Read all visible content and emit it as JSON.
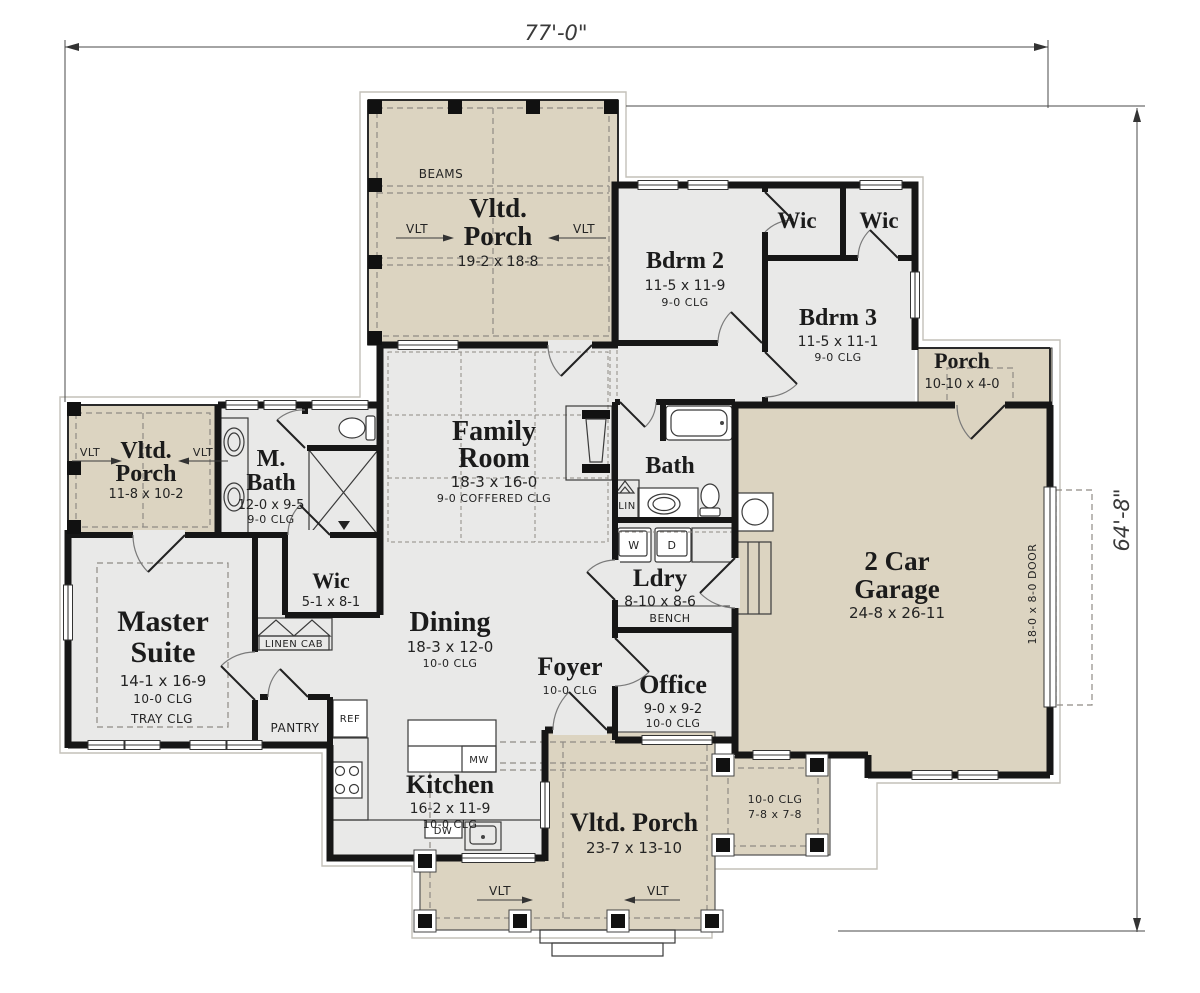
{
  "colors": {
    "paper": "#ffffff",
    "wall": "#161616",
    "porch": "#dcd4c1",
    "room": "#e9e9e8",
    "dash": "#8f8b85",
    "outline": "#c3c0b9"
  },
  "dim": {
    "width": "77'-0\"",
    "height": "64'-8\""
  },
  "rooms": {
    "porch_top": {
      "l1": "Vltd.",
      "l2": "Porch",
      "size": "19-2 x 18-8",
      "beams": "BEAMS",
      "vlt": "VLT"
    },
    "bdrm2": {
      "name": "Bdrm 2",
      "size": "11-5 x 11-9",
      "clg": "9-0 CLG"
    },
    "wic1": {
      "name": "Wic"
    },
    "wic2": {
      "name": "Wic"
    },
    "bdrm3": {
      "name": "Bdrm 3",
      "size": "11-5 x 11-1",
      "clg": "9-0 CLG"
    },
    "porch_right": {
      "name": "Porch",
      "size": "10-10 x 4-0"
    },
    "family": {
      "l1": "Family",
      "l2": "Room",
      "size": "18-3 x 16-0",
      "clg": "9-0 COFFERED CLG"
    },
    "bath": {
      "name": "Bath",
      "lin": "LIN"
    },
    "m_bath": {
      "l1": "M.",
      "l2": "Bath",
      "size": "12-0 x 9-5",
      "clg": "9-0 CLG"
    },
    "porch_left": {
      "l1": "Vltd.",
      "l2": "Porch",
      "size": "11-8 x 10-2",
      "vlt": "VLT"
    },
    "master": {
      "l1": "Master",
      "l2": "Suite",
      "size": "14-1 x 16-9",
      "clg": "10-0 CLG",
      "tray": "TRAY CLG"
    },
    "wic3": {
      "name": "Wic",
      "size": "5-1 x 8-1"
    },
    "linen_cab": {
      "name": "LINEN CAB"
    },
    "dining": {
      "name": "Dining",
      "size": "18-3 x 12-0",
      "clg": "10-0 CLG"
    },
    "ldry": {
      "name": "Ldry",
      "size": "8-10 x 8-6",
      "w": "W",
      "d": "D",
      "bench": "BENCH"
    },
    "garage": {
      "l1": "2 Car",
      "l2": "Garage",
      "size": "24-8 x 26-11",
      "door": "18-0 x 8-0 DOOR"
    },
    "foyer": {
      "name": "Foyer",
      "clg": "10-0 CLG"
    },
    "office": {
      "name": "Office",
      "size": "9-0 x 9-2",
      "clg": "10-0 CLG"
    },
    "pantry": {
      "name": "PANTRY"
    },
    "kitchen": {
      "name": "Kitchen",
      "size": "16-2 x 11-9",
      "clg": "10-0 CLG",
      "ref": "REF",
      "mw": "MW",
      "dw": "DW"
    },
    "porch_bottom": {
      "name": "Vltd. Porch",
      "size": "23-7 x 13-10",
      "vlt": "VLT"
    },
    "porch_small": {
      "clg": "10-0 CLG",
      "size": "7-8 x 7-8"
    }
  }
}
